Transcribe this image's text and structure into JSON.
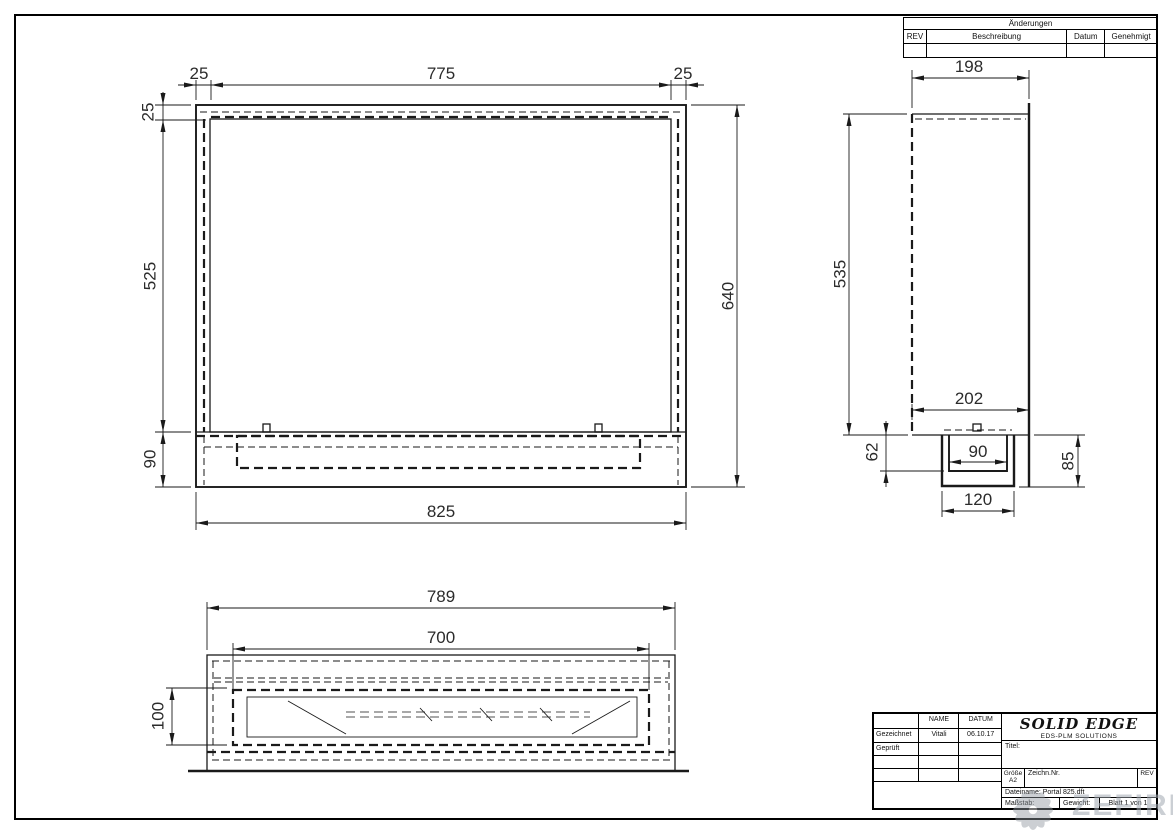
{
  "sheet": {
    "background": "#ffffff",
    "line_color": "#1a1a1a"
  },
  "revision_table": {
    "title": "Änderungen",
    "col_rev": "REV",
    "col_beschreibung": "Beschreibung",
    "col_datum": "Datum",
    "col_genehmigt": "Genehmigt"
  },
  "dimensions": {
    "front": {
      "left_wall": "25",
      "opening_width": "775",
      "right_wall": "25",
      "top_wall": "25",
      "opening_height": "525",
      "base_height": "90",
      "overall_height": "640",
      "overall_width": "825"
    },
    "side": {
      "depth": "198",
      "body_height": "535",
      "base_depth": "202",
      "tray_inner_depth": "62",
      "tray_inner_width": "90",
      "tray_height": "85",
      "tray_width": "120"
    },
    "bottom": {
      "overall_width": "789",
      "tray_width": "700",
      "tray_depth": "100"
    }
  },
  "title_block": {
    "col_name": "NAME",
    "col_datum": "DATUM",
    "row_drawn_label": "Gezeichnet",
    "row_drawn_name": "Vitali",
    "row_drawn_date": "06.10.17",
    "row_checked_label": "Geprüft",
    "brand": "SOLID EDGE",
    "brand_sub": "EDS-PLM SOLUTIONS",
    "titel_label": "Titel:",
    "size_label": "Größe",
    "size_value": "A2",
    "drawing_no_label": "Zeichn.Nr.",
    "rev_label": "REV",
    "filename_label": "Dateiname:",
    "filename_value": "Portal 825.dft",
    "scale_label": "Maßstab:",
    "weight_label": "Gewicht:",
    "sheet_label": "Blatt 1 von 1"
  },
  "watermark": {
    "text": "ZEFIRE"
  }
}
